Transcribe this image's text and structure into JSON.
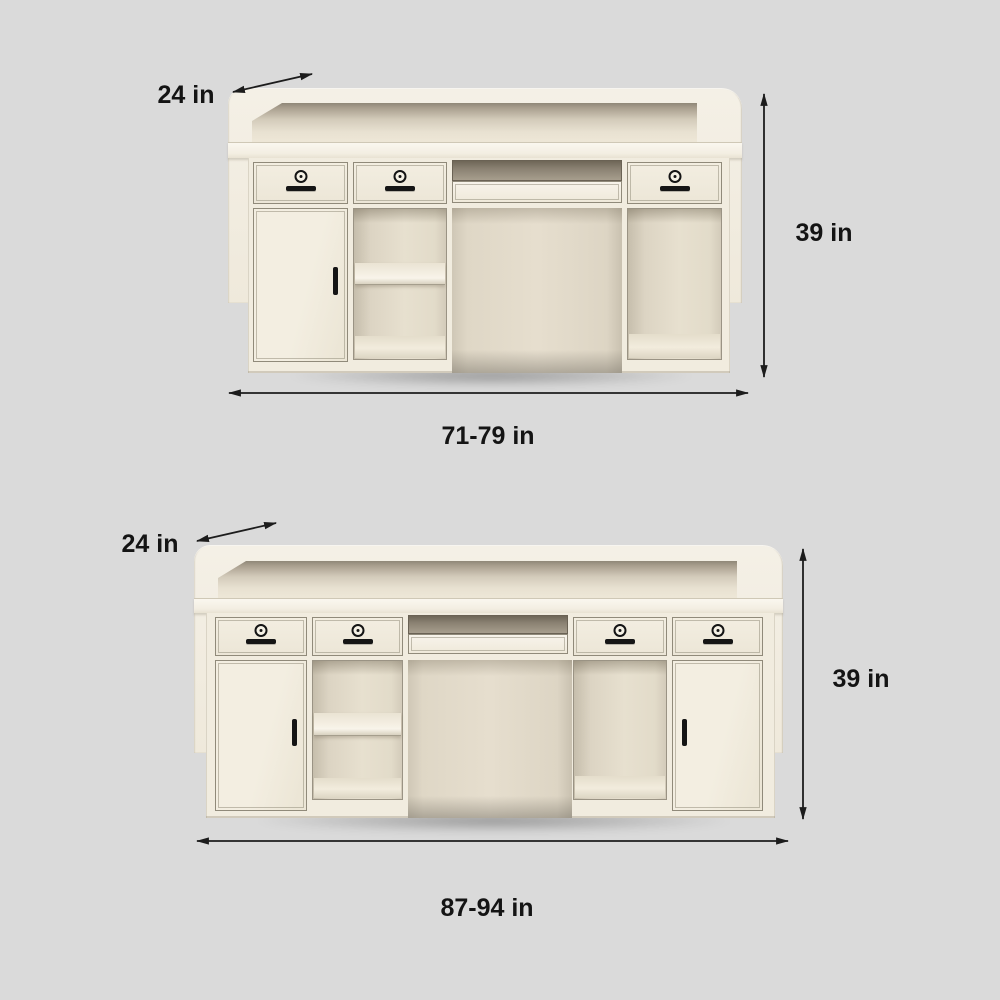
{
  "page": {
    "background_color": "#dadada"
  },
  "palette": {
    "desk_ivory": "#f1ecdf",
    "desk_ivory_light": "#f7f3ea",
    "interior_beige": "#e6dfcf",
    "keyboard_slot_brown": "#8a8172",
    "outline_gray": "#908a7a",
    "annotation_black": "#141414"
  },
  "figures": [
    {
      "name": "reception-desk-small",
      "depth_label": "24 in",
      "height_label": "39 in",
      "width_label": "71-79 in"
    },
    {
      "name": "reception-desk-large",
      "depth_label": "24 in",
      "height_label": "39 in",
      "width_label": "87-94 in"
    }
  ]
}
